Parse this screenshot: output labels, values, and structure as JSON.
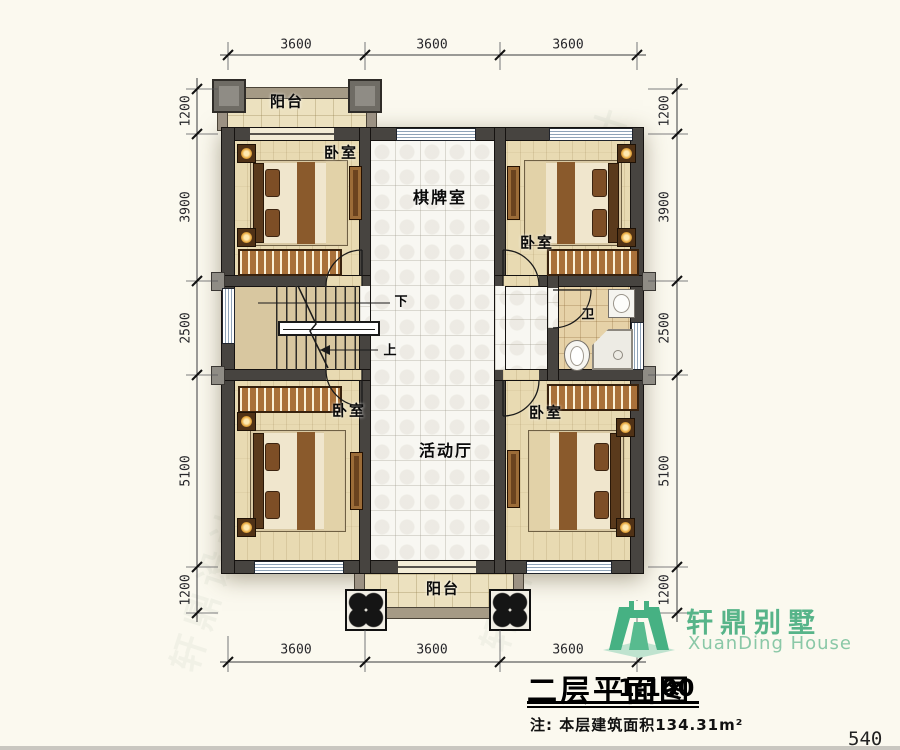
{
  "page": {
    "number": "540"
  },
  "title_block": {
    "title": "二层平面图",
    "scale": "1:100",
    "note": "注: 本层建筑面积134.31m²"
  },
  "logo": {
    "cn": "轩鼎别墅",
    "en": "XuanDing House"
  },
  "rooms": {
    "balcony_top": "阳台",
    "balcony_bottom": "阳台",
    "bedroom_tl": "卧室",
    "bedroom_tr": "卧室",
    "bedroom_bl": "卧室",
    "bedroom_br": "卧室",
    "game_room": "棋牌室",
    "activity_hall": "活动厅",
    "bath": "卫"
  },
  "stairs": {
    "down": "下",
    "up": "上"
  },
  "dims": {
    "top": [
      "3600",
      "3600",
      "3600"
    ],
    "bottom": [
      "3600",
      "3600",
      "3600"
    ],
    "left": [
      "1200",
      "3900",
      "2500",
      "5100",
      "1200"
    ],
    "right": [
      "1200",
      "3900",
      "2500",
      "5100",
      "1200"
    ]
  },
  "watermark": {
    "text": "轩鼎设计"
  },
  "colors": {
    "wall": "#474440",
    "logo_green": "#46b183",
    "floor_wood": "#e8dab2",
    "floor_tile": "#f8f7f2",
    "background": "#fbf9ef"
  }
}
